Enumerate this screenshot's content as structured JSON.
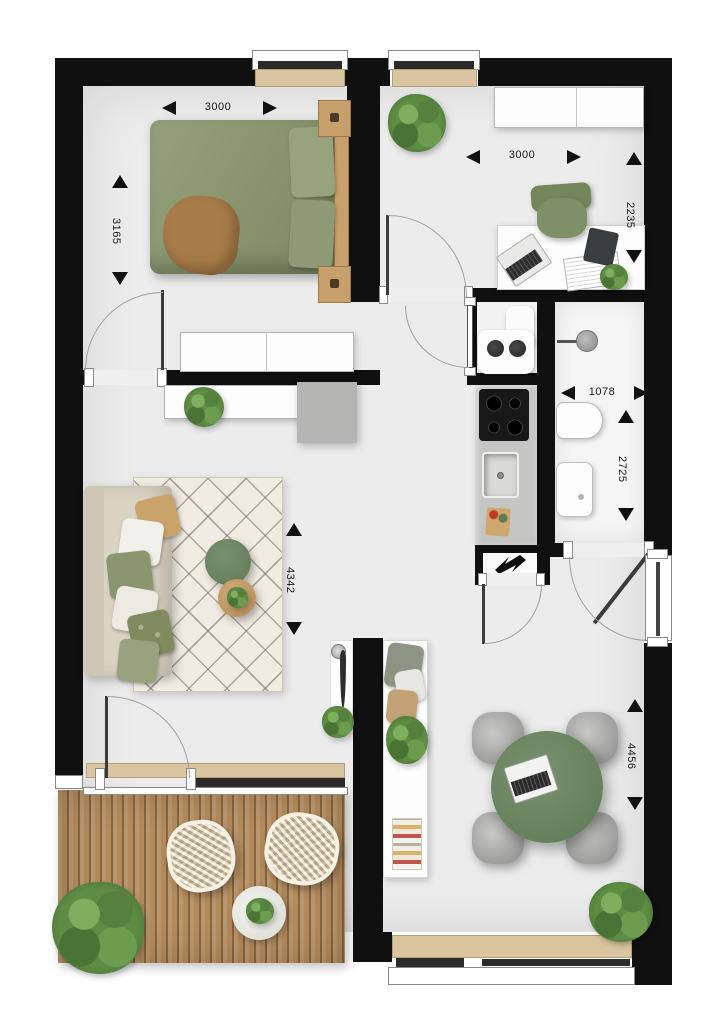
{
  "plan": {
    "type": "apartment-floor-plan",
    "dimensions": {
      "bedroom_width": "3000",
      "bedroom_depth": "3165",
      "office_width": "3000",
      "office_depth": "2235",
      "bathroom_width": "1078",
      "bathroom_depth": "2725",
      "living_room_depth": "4342",
      "dining_area_depth": "4456"
    },
    "icons": {
      "electrical": "lightning-bolt-icon"
    },
    "colors": {
      "wall": "#101010",
      "floor": "#ececec",
      "accent_green": "#6d8763",
      "duvet_green": "#8b9770",
      "wood_deck": "#b28a5c",
      "window_sill": "#d9c6a0",
      "counter_gray": "#c5c5c3"
    }
  }
}
